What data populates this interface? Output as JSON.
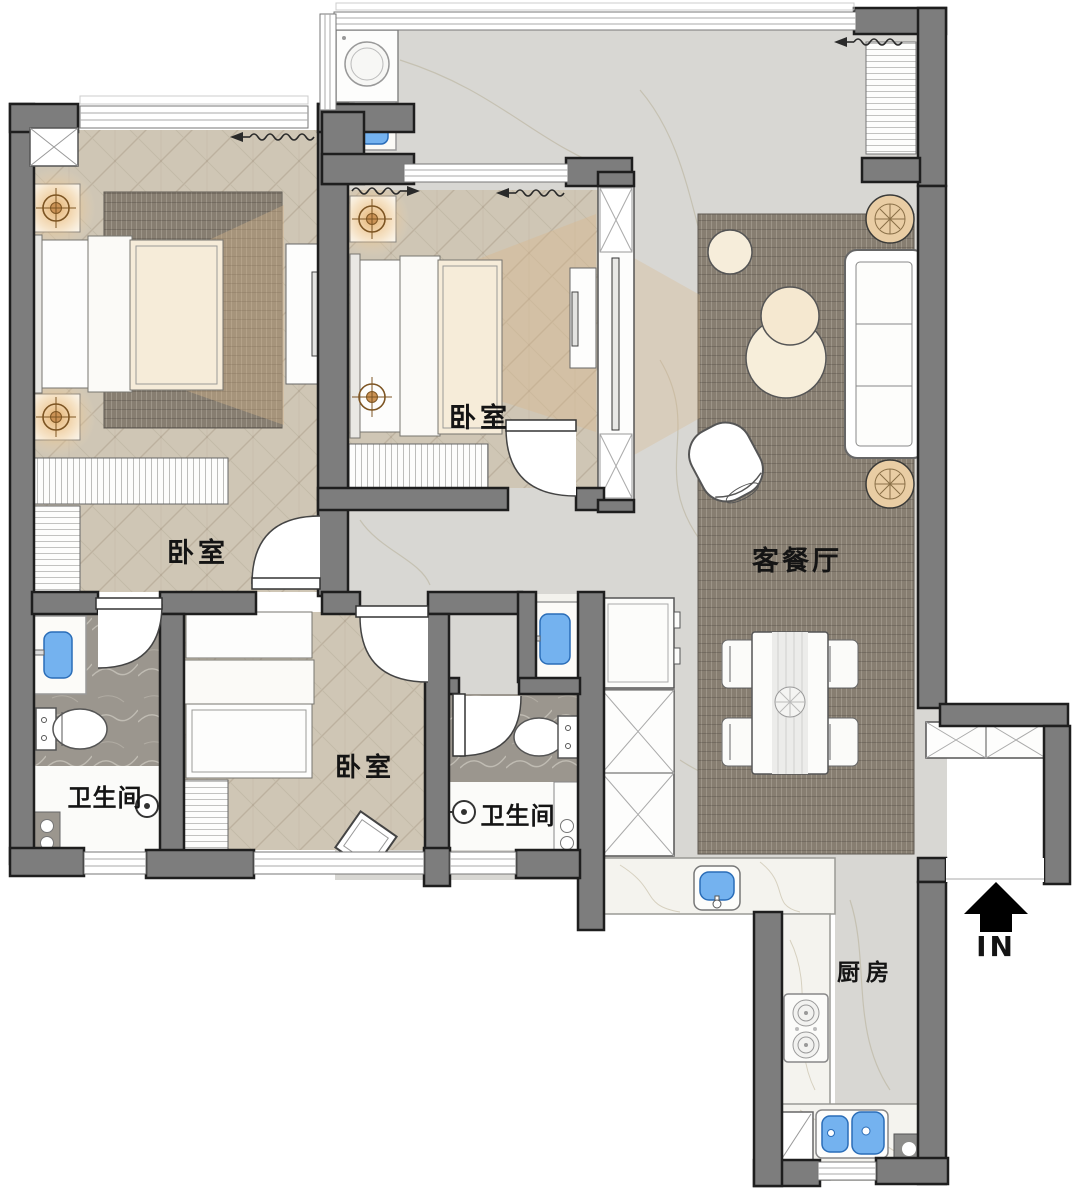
{
  "floorplan": {
    "rooms": {
      "bedroom_master": {
        "label": "卧室"
      },
      "bedroom_middle": {
        "label": "卧室"
      },
      "bedroom_small": {
        "label": "卧室"
      },
      "living_dining": {
        "label": "客餐厅"
      },
      "bathroom_master": {
        "label": "卫生间"
      },
      "bathroom_shared": {
        "label": "卫生间"
      },
      "kitchen": {
        "label": "厨房"
      }
    },
    "entrance": {
      "label": "IN"
    },
    "icons": {
      "entry_arrow": "up-arrow",
      "ceiling_lamp": "crosshair-target",
      "shower": "shower-head",
      "curtain": "wavy-arrow",
      "column": "x-box"
    },
    "colors": {
      "wall": "#7d7d7d",
      "wall_outline": "#1e1e1e",
      "wood_floor": "#cfc6b5",
      "marble_floor": "#d8d7d3",
      "dark_marble": "#9b968e",
      "counter_marble": "#f4f3ee",
      "rug": "#8a8174",
      "sink_blue": "#74b2ef",
      "lamp_orange": "#bc8440",
      "light_cone": "#d9b98c",
      "plant": "#e5c79e",
      "label_text": "#141414"
    }
  }
}
